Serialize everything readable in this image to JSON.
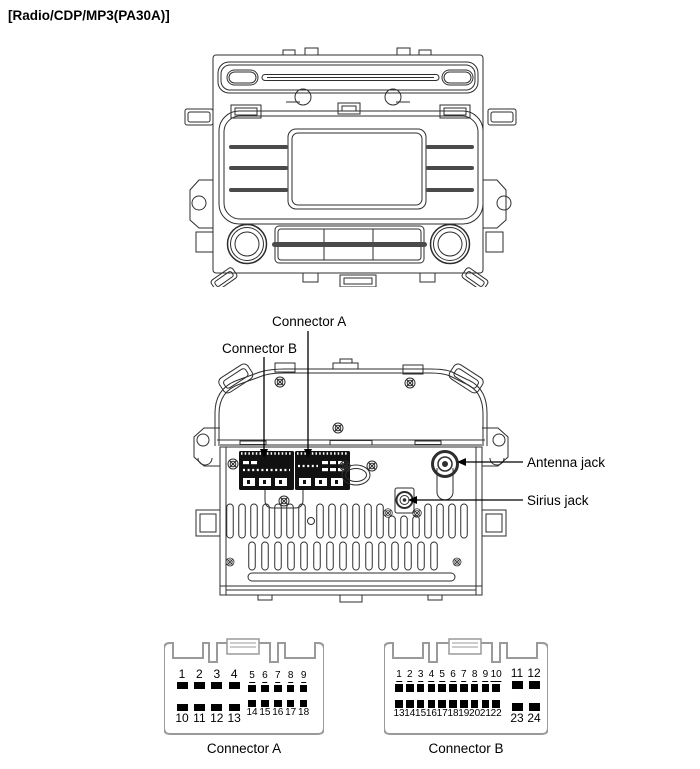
{
  "title": "[Radio/CDP/MP3(PA30A)]",
  "callouts": {
    "connector_a": "Connector A",
    "connector_b": "Connector B",
    "antenna_jack": "Antenna jack",
    "sirius_jack": "Sirius jack"
  },
  "pinouts": [
    {
      "id": "connector-a",
      "label": "Connector A",
      "groups": [
        {
          "pins": [
            1,
            2,
            3,
            4
          ],
          "start_x": 18,
          "spacing": 17.4,
          "y": 42,
          "pin_w": 11,
          "pin_h": 7,
          "numbers": "above",
          "font": 12,
          "underline": false
        },
        {
          "pins": [
            5,
            6,
            7,
            8,
            9
          ],
          "start_x": 88,
          "spacing": 12.9,
          "y": 45.5,
          "pin_w": 7.5,
          "pin_h": 7.5,
          "numbers": "above",
          "font": 10,
          "underline": true
        },
        {
          "pins": [
            10,
            11,
            12,
            13
          ],
          "start_x": 18,
          "spacing": 17.4,
          "y": 64,
          "pin_w": 11,
          "pin_h": 7,
          "numbers": "below",
          "font": 12,
          "underline": false
        },
        {
          "pins": [
            14,
            15,
            16,
            17,
            18
          ],
          "start_x": 88,
          "spacing": 12.9,
          "y": 60.5,
          "pin_w": 7.5,
          "pin_h": 7.5,
          "numbers": "below",
          "font": 10,
          "underline": false
        }
      ]
    },
    {
      "id": "connector-b",
      "label": "Connector B",
      "groups": [
        {
          "pins": [
            1,
            2,
            3,
            4,
            5,
            6,
            7,
            8,
            9,
            10
          ],
          "start_x": 15,
          "spacing": 10.8,
          "y": 45,
          "pin_w": 7.5,
          "pin_h": 7.5,
          "numbers": "above",
          "font": 10,
          "underline": true
        },
        {
          "pins": [
            11,
            12
          ],
          "start_x": 133,
          "spacing": 17,
          "y": 42,
          "pin_w": 11,
          "pin_h": 7.5,
          "numbers": "above",
          "font": 12,
          "underline": false
        },
        {
          "pins": [
            13,
            14,
            15,
            16,
            17,
            18,
            19,
            20,
            21,
            22
          ],
          "start_x": 15,
          "spacing": 10.8,
          "y": 61,
          "pin_w": 7.5,
          "pin_h": 7.5,
          "numbers": "below",
          "font": 10,
          "underline": false
        },
        {
          "pins": [
            23,
            24
          ],
          "start_x": 133,
          "spacing": 17,
          "y": 64,
          "pin_w": 11,
          "pin_h": 7.5,
          "numbers": "below",
          "font": 12,
          "underline": false
        }
      ]
    }
  ],
  "colors": {
    "background": "#ffffff",
    "ink": "#000000",
    "line": "#2e2e2e",
    "housing_outline": "#9a9a9a",
    "connector_fill": "#111111"
  }
}
